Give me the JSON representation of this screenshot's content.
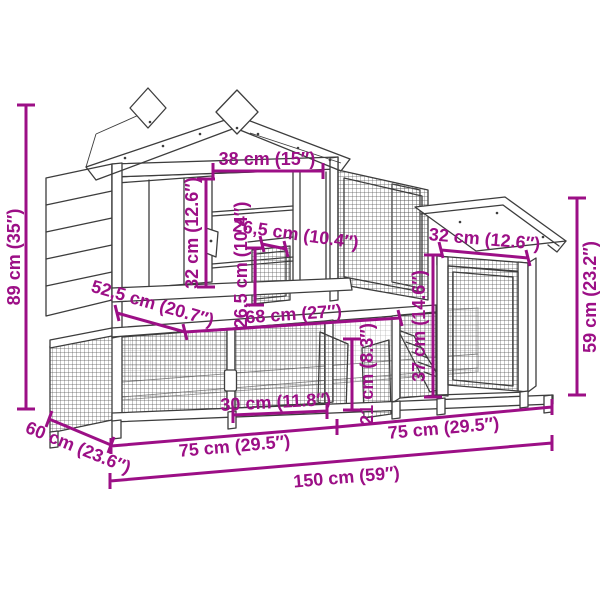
{
  "drawing": {
    "subject": "wooden chicken coop / rabbit hutch dimension diagram",
    "background": "#ffffff",
    "line_color": "#3d3d3d",
    "mesh_color": "#555555",
    "dimension_color": "#9c0f86"
  },
  "dims": {
    "total_height": "89 cm (35″)",
    "roof_front_width": "38 cm (15″)",
    "front_door_height": "32 cm (12.6″)",
    "inner_opening_height": "26,5 cm (10.4″)",
    "inner_opening_width": "26,5 cm (10.4″)",
    "upper_depth": "52,5 cm (20.7″)",
    "upper_front_width": "68 cm (27″)",
    "right_house_width": "32 cm (12.6″)",
    "right_house_height": "59 cm (23.2″)",
    "run_panel_height": "37 cm (14.6″)",
    "run_panel_width": "30 cm (11.8″)",
    "run_door_height": "21 cm (8.3″)",
    "base_left_width": "75 cm (29.5″)",
    "base_right_width": "75 cm (29.5″)",
    "base_depth": "60 cm (23.6″)",
    "total_width": "150 cm (59″)"
  }
}
